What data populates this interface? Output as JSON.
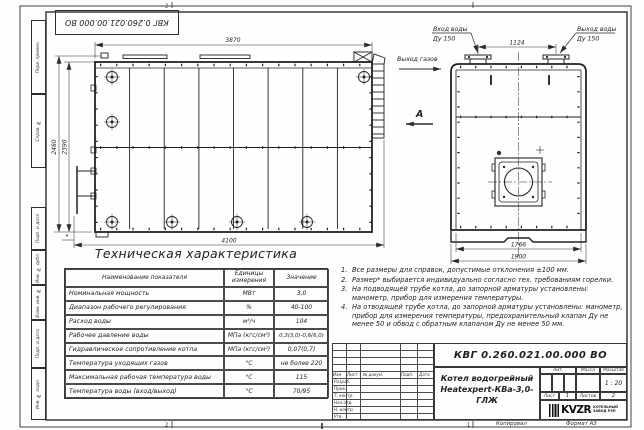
{
  "colors": {
    "ink": "#2b2b2b",
    "paper": "#fefefe"
  },
  "frame": {
    "zone2": "2",
    "zone1": "1",
    "side_labels": [
      "Перв. примен.",
      "Справ. №",
      "Подп. и дата",
      "Инв. № дубл.",
      "Взам. инв. №",
      "Подп. и дата",
      "Инв. № подл."
    ],
    "footer_copy": "Копировал",
    "footer_format": "Формат А3"
  },
  "drawing": {
    "dims": {
      "d3870": "3870",
      "d2480": "2480",
      "d2390": "2390",
      "d4100": "4100",
      "star": "*",
      "d1124": "1124",
      "d1766": "1766",
      "d1900": "1900"
    },
    "labels": {
      "gas_out": "Выход газов",
      "view_a": "А",
      "water_in": "Вход воды",
      "water_in_dn": "Ду 150",
      "water_out": "Выход воды",
      "water_out_dn": "Ду 150"
    }
  },
  "table": {
    "title": "Техническая характеристика",
    "headers": [
      "Наименование показателя",
      "Единицы измерения",
      "Значение"
    ],
    "rows": [
      [
        "Номинальная мощность",
        "МВт",
        "3,0"
      ],
      [
        "Диапазон рабочего регулирования",
        "%",
        "40-100"
      ],
      [
        "Расход воды",
        "м³/ч",
        "104"
      ],
      [
        "Рабочее давление воды",
        "МПа (кгс/см²)",
        "0,3(3,0)-0,6(6,0)"
      ],
      [
        "Гидравлическое сопротивление котла",
        "МПа (кгс/см²)",
        "0,07(0,7)"
      ],
      [
        "Температура уходящих газов",
        "°С",
        "не более 220"
      ],
      [
        "Максимальная рабочая температура воды",
        "°С",
        "115"
      ],
      [
        "Температура воды (вход/выход)",
        "°С",
        "70/95"
      ]
    ]
  },
  "notes": [
    {
      "n": "1.",
      "text": "Все размеры для справок, допустимые отклонения ±100 мм."
    },
    {
      "n": "2.",
      "text": "Размер* выбирается индивидуально согласно тех. требованиям горелки."
    },
    {
      "n": "3.",
      "text": "На подводящей трубе котла, до запорной арматуры установлены: манометр, прибор для измерения температуры."
    },
    {
      "n": "4.",
      "text": "На отводящей трубе котла, до запорной арматуры установлены: манометр, прибор для измерения температуры, предохранительный клапан Ду не менее 50 и обвод с обратным клапаном Ду не менее 50 мм."
    }
  ],
  "title_block": {
    "doc_number": "КВГ 0.260.021.00.000 ВО",
    "product_name_1": "Котел водогрейный",
    "product_name_2": "Heatexpert-КВа-3,0-ГЛЖ",
    "header_cols": [
      "Изм",
      "Лист",
      "№ докум.",
      "Подп.",
      "Дата"
    ],
    "row_labels": [
      "Разраб.",
      "Пров.",
      "Т. контр.",
      "Нач.отд.",
      "Н. контр.",
      "Утв."
    ],
    "lit_label": "Лит.",
    "mass_label": "Масса",
    "scale_label": "Масштаб",
    "scale_value": "1 : 20",
    "sheet_label": "Лист",
    "sheet_value": "1",
    "sheets_label": "Листов",
    "sheets_value": "2",
    "logo_text": "KVZR",
    "logo_sub1": "КОТЕЛЬНЫЙ",
    "logo_sub2": "ЗАВОД РЭП"
  }
}
